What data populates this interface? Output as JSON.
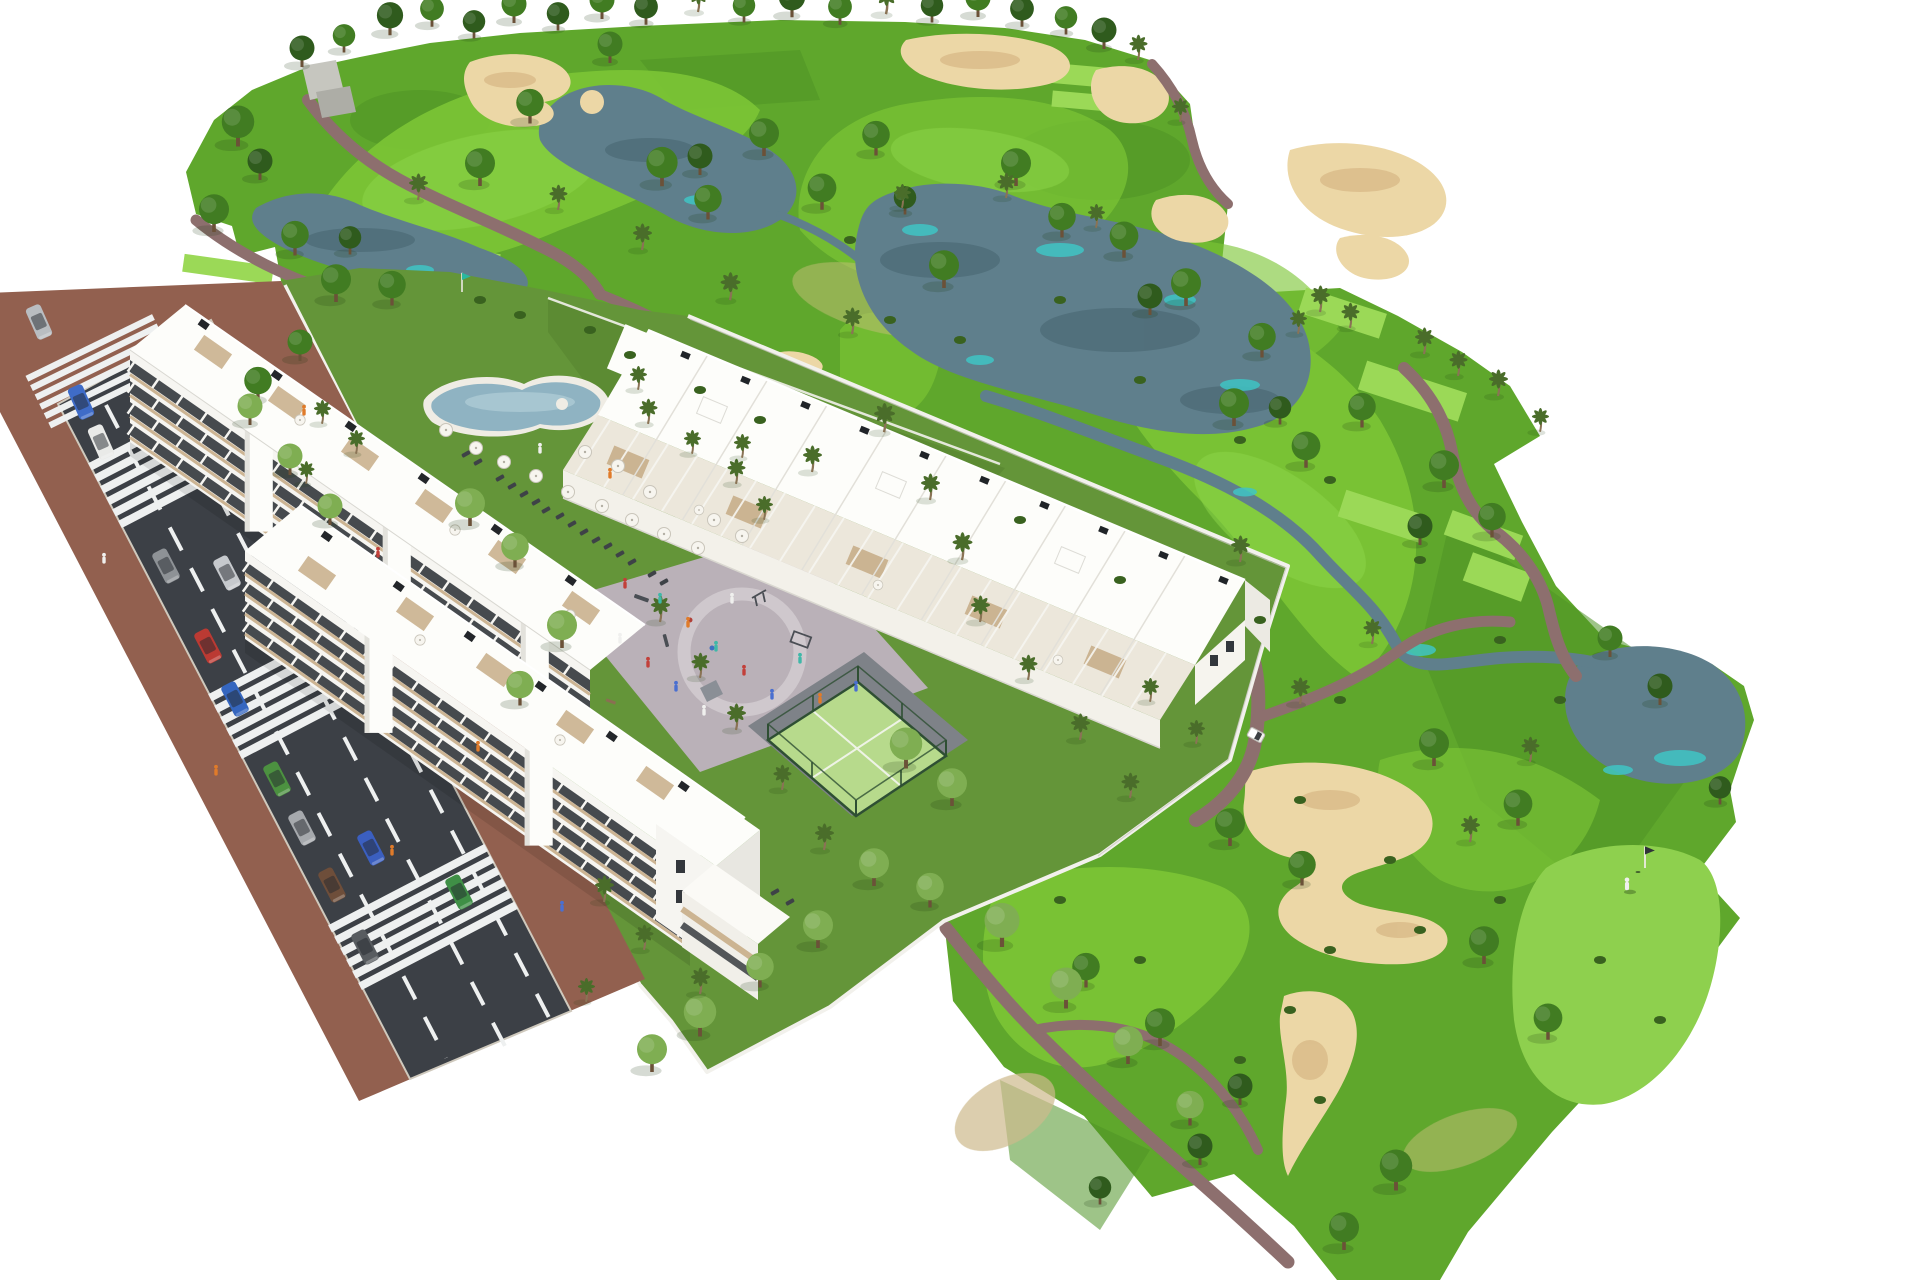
{
  "meta": {
    "subject": "Aerial 3D architectural rendering of a white Mediterranean apartment complex beside a golf course",
    "view": "high-angle aerial axonometric render on white background",
    "background_color": "#ffffff"
  },
  "palette": {
    "canvas": "#ffffff",
    "grass_base": "#5fa72c",
    "grass_rough": "#4f9426",
    "fairway": "#7cc636",
    "fairway_bright": "#8fd64a",
    "tee": "#9bd957",
    "green_putting": "#8ed04e",
    "lawn_pool": "#5c8b33",
    "garden_lawn": "#649539",
    "dry_grass": "#bdbd74",
    "dry_sandy": "#cdb98c",
    "tree_dark": "#2f5b1d",
    "tree_mid": "#417c22",
    "tree_pale": "#7fae52",
    "palm": "#4a6d2a",
    "bush": "#39621f",
    "lake": "#5f7f8c",
    "lake_teal": "#3fc4c4",
    "lake_reflection": "#44616c",
    "sand": "#ecd7a6",
    "sand_shadow": "#d9ba88",
    "path": "#8d6f6e",
    "road_asphalt": "#3c4046",
    "road_marking": "#eef0f0",
    "sidewalk": "#92604f",
    "wall_white": "#f2f1ec",
    "building_white": "#fdfdfa",
    "building_face": "#f6f5f1",
    "glass": "#383c41",
    "accent_tan": "#c8ae89",
    "pool_water": "#8fb3c2",
    "pool_deck": "#efece4",
    "plaza": "#bab1b8",
    "plaza_ring": "#cfc8cd",
    "padel_surface": "#b7da8c",
    "padel_fence": "#2e4f33",
    "equipment_grey": "#4a4e54",
    "clubhouse_grey": "#c6c6bf",
    "flag_teal": "#2ab8a0",
    "person_orange": "#e07b2a",
    "person_red": "#c2403a",
    "person_blue": "#4a6fd0",
    "person_white": "#f0f0ee",
    "person_teal": "#3fb8a8"
  },
  "scene": {
    "golf_course": {
      "label": "golf-course",
      "lakes": [
        "upper-center-lake",
        "top-left-lake",
        "central-lake",
        "lower-right-lake"
      ],
      "creeks": 2,
      "bunker_clusters": 9,
      "tee_boxes": 11,
      "putting_greens": [
        "practice-green-with-flag",
        "lower-right-green-with-flag"
      ],
      "flags": 2,
      "golfer_present": true,
      "golf_cart_present": true,
      "horizon_trees": 20
    },
    "development": {
      "label": "residential-complex",
      "blocks": [
        {
          "name": "apartment-block-a",
          "storeys": 4,
          "style": "white slab, glazed bands, roof terraces"
        },
        {
          "name": "apartment-block-b",
          "storeys": 4,
          "style": "white slab, glazed bands, roof terraces, end tower"
        },
        {
          "name": "townhouse-row-c",
          "storeys": 3,
          "style": "white townhouses with pergola roof terraces"
        }
      ],
      "amenities": [
        "swimming-pool",
        "pool-lawn",
        "parasols",
        "sun-loungers",
        "playground-plaza",
        "padel-court",
        "private-gardens",
        "white-perimeter-walls"
      ],
      "parasols": 22,
      "sun_loungers": 18
    },
    "street": {
      "label": "access-road",
      "lane_markings": "dashed-white",
      "crosswalks": 4,
      "cars_parked": [
        {
          "color": "#b9bdc1",
          "type": "car"
        },
        {
          "color": "#3f6cc8",
          "type": "car"
        },
        {
          "color": "#e9eae8",
          "type": "car"
        },
        {
          "color": "#8e9296",
          "type": "car"
        },
        {
          "color": "#bb3a33",
          "type": "car"
        },
        {
          "color": "#3566bf",
          "type": "car"
        },
        {
          "color": "#4c9140",
          "type": "car"
        },
        {
          "color": "#a6a9ad",
          "type": "car"
        },
        {
          "color": "#6e4e3a",
          "type": "car"
        },
        {
          "color": "#585c60",
          "type": "car"
        }
      ],
      "cars_moving": [
        {
          "color": "#c6c9cd",
          "type": "car"
        },
        {
          "color": "#3b5fc0",
          "type": "car"
        },
        {
          "color": "#3f8f46",
          "type": "car"
        },
        {
          "color": "#4a4e54",
          "type": "car"
        }
      ],
      "pedestrians_present": true
    },
    "vegetation": {
      "deciduous_trees": 88,
      "palm_trees": 49,
      "bushes": 32
    }
  }
}
